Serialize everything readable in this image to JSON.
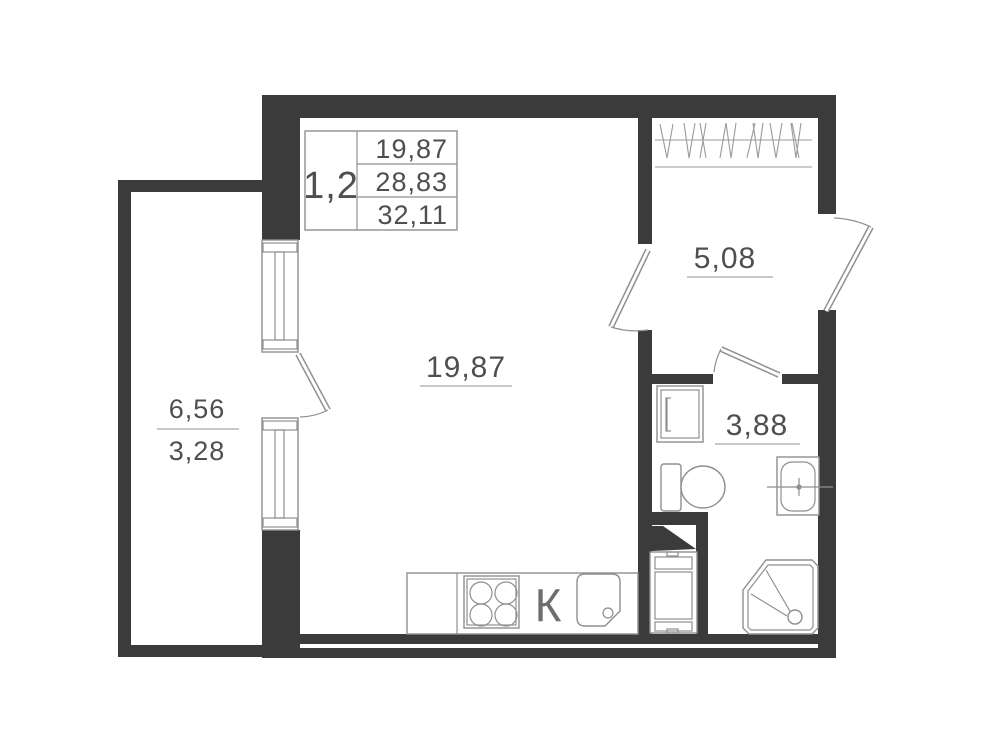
{
  "plan": {
    "unit_table": {
      "unit": "1,2",
      "rows": [
        "19,87",
        "28,83",
        "32,11"
      ]
    },
    "rooms": {
      "living": {
        "area": "19,87"
      },
      "hallway": {
        "area": "5,08"
      },
      "bathroom": {
        "area": "3,88"
      },
      "balcony": {
        "area_total": "6,56",
        "area_counted": "3,28"
      },
      "kitchen": {
        "label": "К"
      }
    },
    "colors": {
      "wall": "#3b3b3b",
      "fixture_line": "#8f8f8f",
      "text": "#4f4f4f"
    }
  }
}
